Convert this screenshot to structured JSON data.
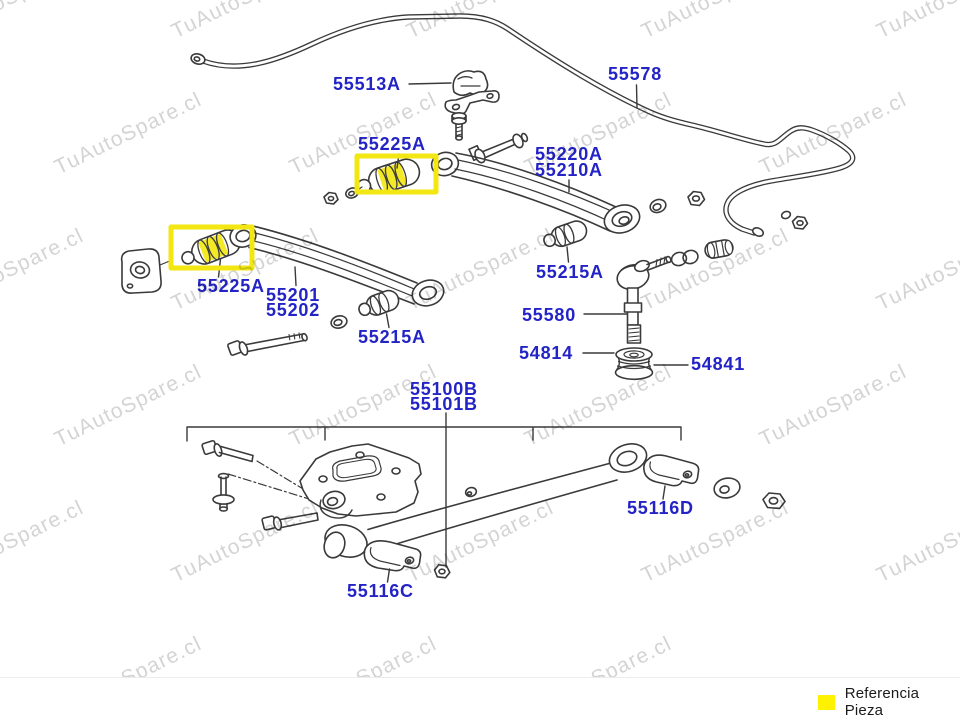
{
  "watermark": {
    "text": "TuAutoSpare.cl"
  },
  "diagram": {
    "label_color": "#2424c6",
    "highlight_color": "#f2e713",
    "line_color": "#3a3a3a",
    "labels": [
      {
        "text": "55513A",
        "x": 333,
        "y": 75
      },
      {
        "text": "55578",
        "x": 608,
        "y": 65
      },
      {
        "text": "55225A",
        "x": 358,
        "y": 135
      },
      {
        "text": "55220A",
        "x": 535,
        "y": 145
      },
      {
        "text": "55210A",
        "x": 535,
        "y": 161
      },
      {
        "text": "55215A",
        "x": 536,
        "y": 263
      },
      {
        "text": "55225A",
        "x": 197,
        "y": 277
      },
      {
        "text": "55201",
        "x": 266,
        "y": 286
      },
      {
        "text": "55202",
        "x": 266,
        "y": 301
      },
      {
        "text": "55215A",
        "x": 358,
        "y": 328
      },
      {
        "text": "55580",
        "x": 522,
        "y": 306
      },
      {
        "text": "54814",
        "x": 519,
        "y": 344
      },
      {
        "text": "54841",
        "x": 691,
        "y": 355
      },
      {
        "text": "55100B",
        "x": 410,
        "y": 380
      },
      {
        "text": "55101B",
        "x": 410,
        "y": 395
      },
      {
        "text": "55116D",
        "x": 627,
        "y": 499
      },
      {
        "text": "55116C",
        "x": 347,
        "y": 582
      }
    ]
  },
  "legend": {
    "label": "Referencia Pieza",
    "swatch_color": "#fff200"
  }
}
